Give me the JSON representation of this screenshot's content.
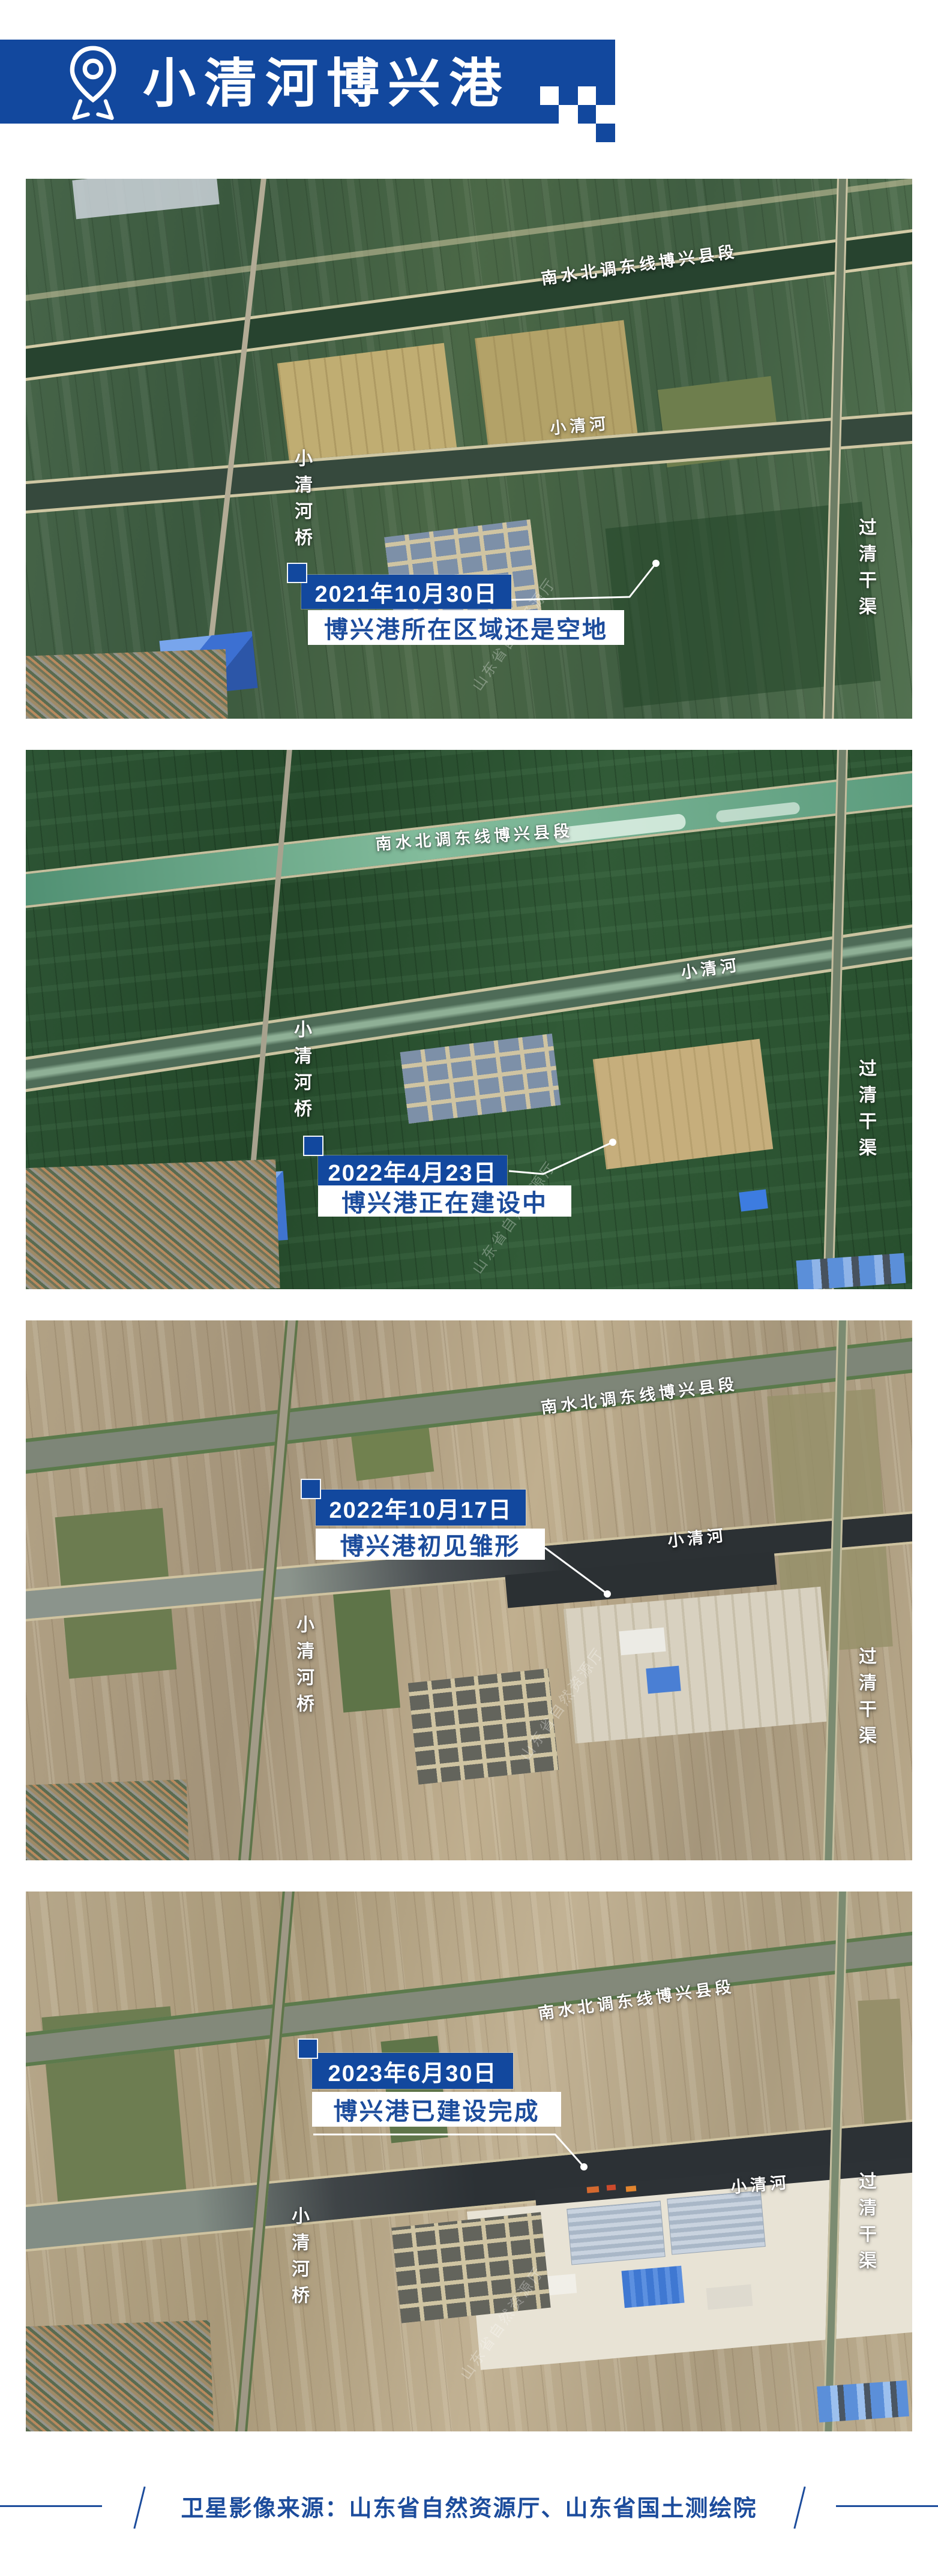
{
  "header": {
    "title": "小清河博兴港"
  },
  "map_labels": {
    "canal": "南水北调东线博兴县段",
    "river": "小清河",
    "bridge": "小清河桥",
    "right_canal": "过清干渠"
  },
  "frames": [
    {
      "date": "2021年10月30日",
      "caption": "博兴港所在区域还是空地"
    },
    {
      "date": "2022年4月23日",
      "caption": "博兴港正在建设中"
    },
    {
      "date": "2022年10月17日",
      "caption": "博兴港初见雏形"
    },
    {
      "date": "2023年6月30日",
      "caption": "博兴港已建设完成"
    }
  ],
  "watermark": "山东省自然资源厅",
  "footer": {
    "source": "卫星影像来源：山东省自然资源厅、山东省国土测绘院"
  },
  "colors": {
    "brand_blue": "#12489E",
    "caption_text_blue": "#1C4C9C",
    "label_white": "#FFFFFF"
  }
}
